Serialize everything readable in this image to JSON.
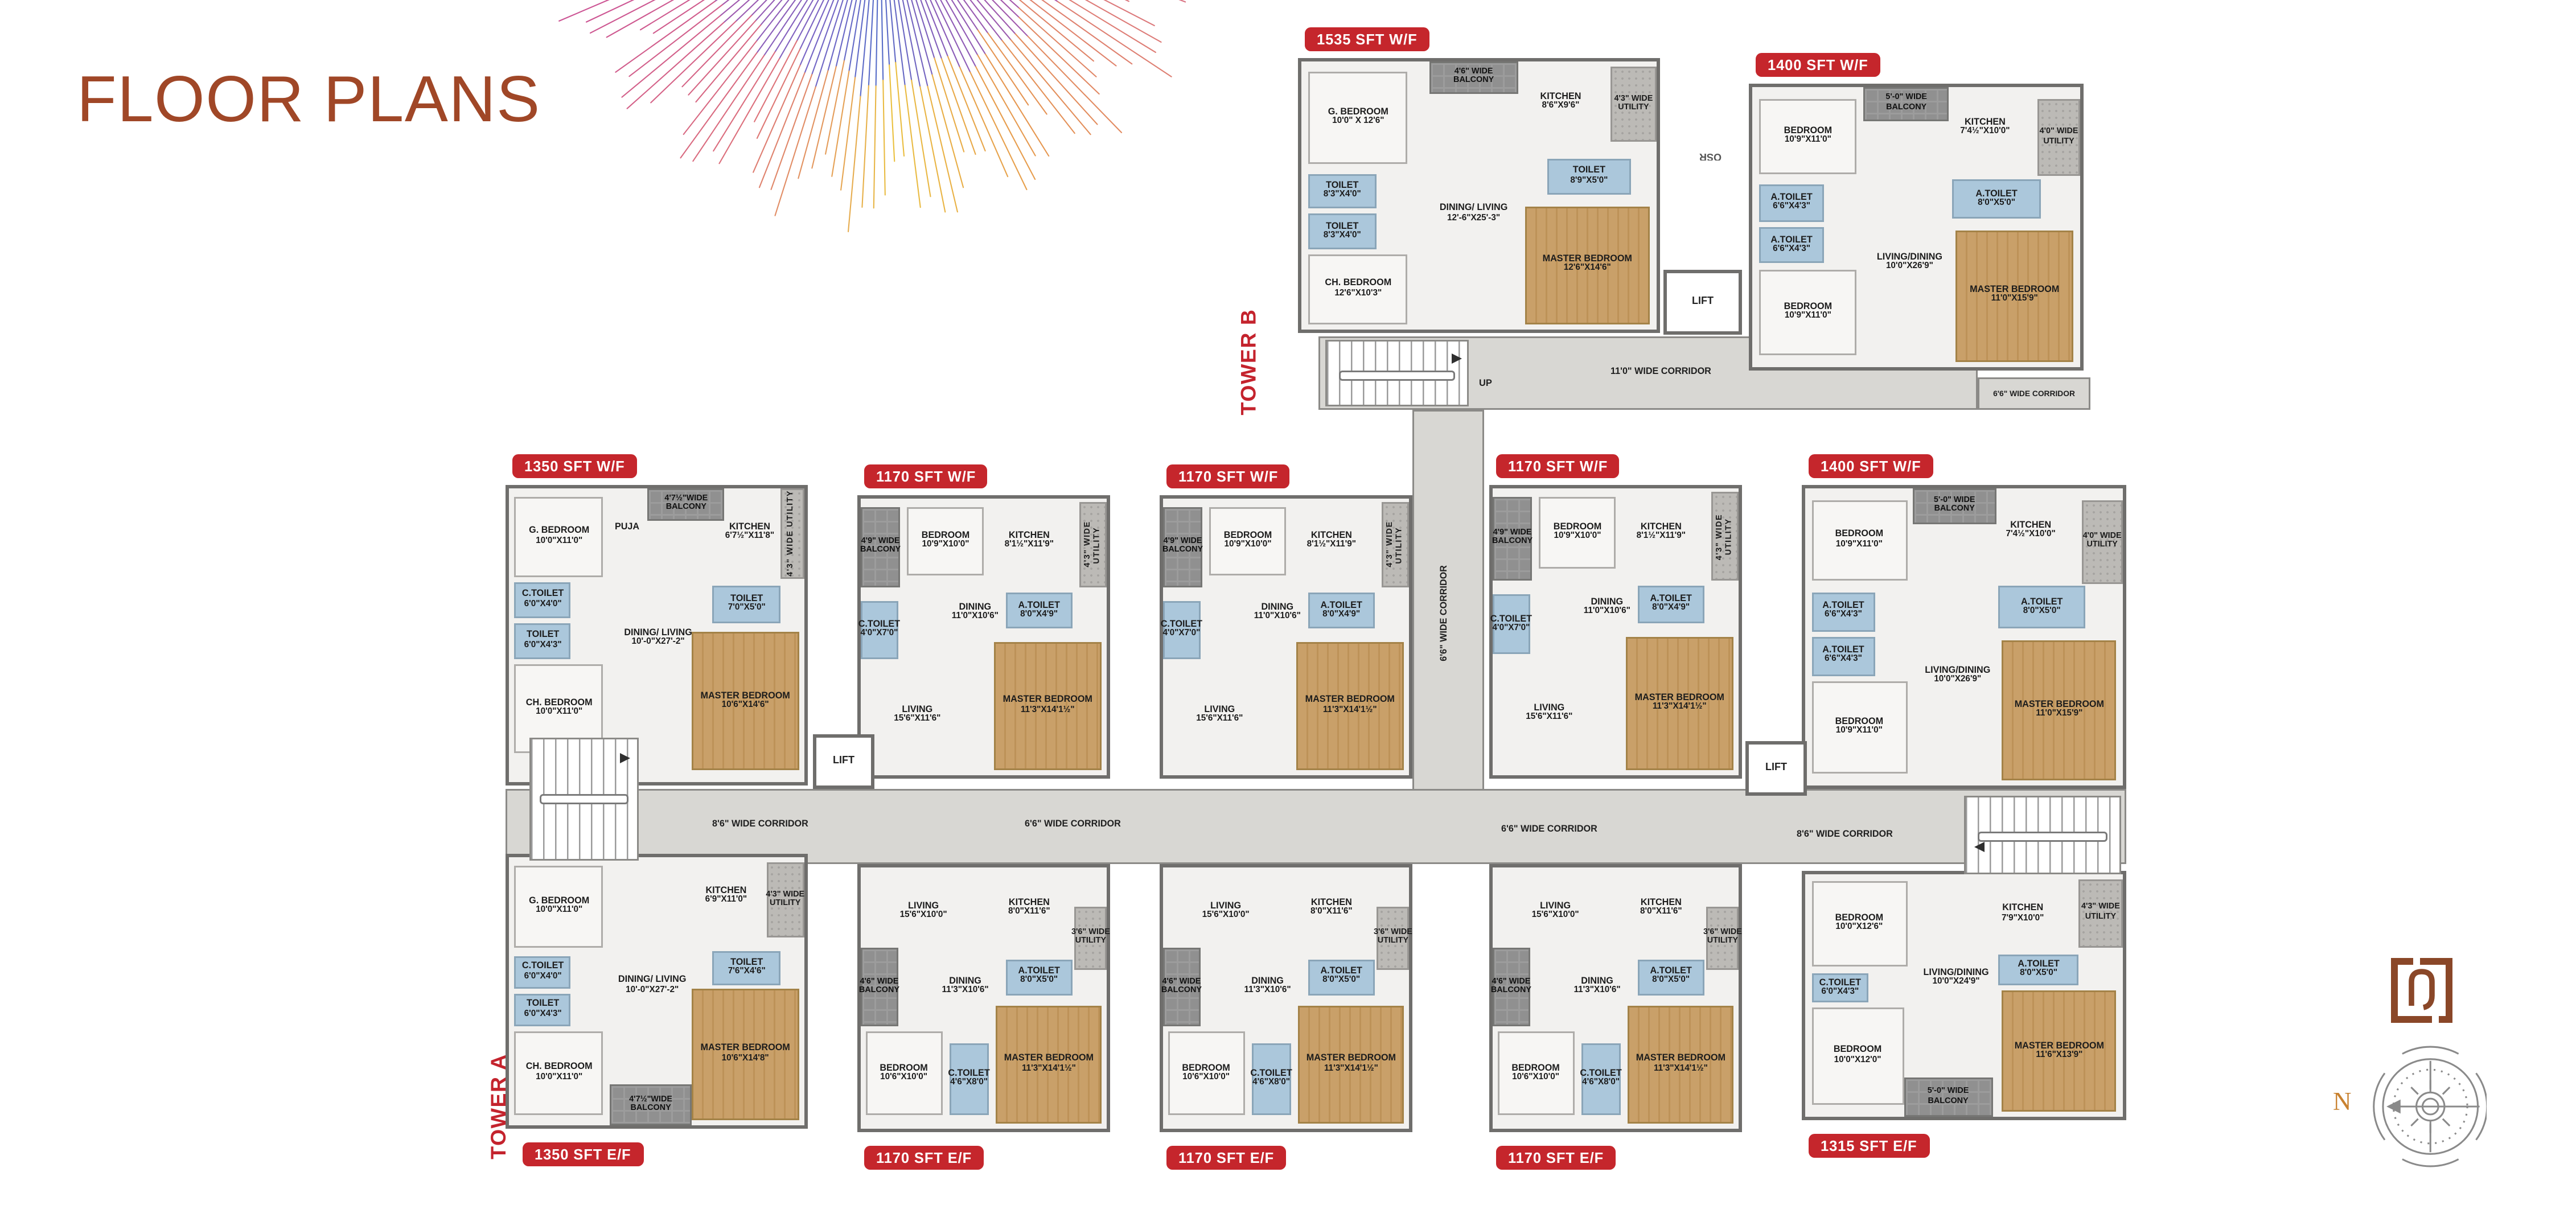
{
  "page": {
    "title": "FLOOR PLANS"
  },
  "colors": {
    "accent_brown": "#a04727",
    "badge_red": "#c5262c",
    "tower_red": "#c4232d",
    "toilet_blue": "#abc7db",
    "wood": "#c9a069",
    "corridor_gray": "#d8d7d3"
  },
  "towers": {
    "a": "TOWER A",
    "b": "TOWER B"
  },
  "corridors": {
    "b_main": "11'0\" WIDE CORRIDOR",
    "b_ext": "6'6\" WIDE CORRIDOR",
    "vertical": "6'6\" WIDE CORRIDOR",
    "a_labels": [
      "8'6\" WIDE CORRIDOR",
      "6'6\" WIDE CORRIDOR",
      "6'6\" WIDE CORRIDOR",
      "8'6\" WIDE CORRIDOR"
    ]
  },
  "misc": {
    "lift": "LIFT",
    "up": "UP",
    "osr": "OSR",
    "north": "N"
  },
  "unit_types": {
    "t1535": {
      "rooms": [
        {
          "n": "G. BEDROOM",
          "d": "10'0\" X 12'6\"",
          "k": "room",
          "x": 2,
          "y": 4,
          "w": 28,
          "h": 34
        },
        {
          "n": "4'6\" WIDE",
          "d": "BALCONY",
          "k": "balcony",
          "x": 36,
          "y": 0,
          "w": 25,
          "h": 12
        },
        {
          "n": "KITCHEN",
          "d": "8'6\"X9'6\"",
          "k": "open",
          "x": 61,
          "y": 5,
          "w": 24,
          "h": 20
        },
        {
          "n": "4'3\" WIDE",
          "d": "UTILITY",
          "k": "utility",
          "x": 87,
          "y": 2,
          "w": 13,
          "h": 28
        },
        {
          "n": "TOILET",
          "d": "8'3\"X4'0\"",
          "k": "toilet",
          "x": 2,
          "y": 42,
          "w": 19,
          "h": 13
        },
        {
          "n": "TOILET",
          "d": "8'3\"X4'0\"",
          "k": "toilet",
          "x": 2,
          "y": 57,
          "w": 19,
          "h": 13
        },
        {
          "n": "TOILET",
          "d": "8'9\"X5'0\"",
          "k": "toilet",
          "x": 69,
          "y": 36,
          "w": 24,
          "h": 14
        },
        {
          "n": "DINING/ LIVING",
          "d": "12'-6\"X25'-3\"",
          "k": "open",
          "x": 33,
          "y": 42,
          "w": 31,
          "h": 30
        },
        {
          "n": "CH. BEDROOM",
          "d": "12'6\"X10'3\"",
          "k": "room",
          "x": 2,
          "y": 72,
          "w": 28,
          "h": 26
        },
        {
          "n": "MASTER BEDROOM",
          "d": "12'6\"X14'6\"",
          "k": "wood",
          "x": 63,
          "y": 54,
          "w": 35,
          "h": 44
        }
      ]
    },
    "t1400": {
      "rooms": [
        {
          "n": "BEDROOM",
          "d": "10'9\"X11'0\"",
          "k": "room",
          "x": 2,
          "y": 4,
          "w": 30,
          "h": 27
        },
        {
          "n": "5'-0\" WIDE",
          "d": "BALCONY",
          "k": "balcony",
          "x": 34,
          "y": 0,
          "w": 26,
          "h": 12
        },
        {
          "n": "KITCHEN",
          "d": "7'4½\"X10'0\"",
          "k": "open",
          "x": 58,
          "y": 5,
          "w": 26,
          "h": 19
        },
        {
          "n": "4'0\" WIDE",
          "d": "UTILITY",
          "k": "utility",
          "x": 87,
          "y": 4,
          "w": 13,
          "h": 28
        },
        {
          "n": "A.TOILET",
          "d": "6'6\"X4'3\"",
          "k": "toilet",
          "x": 2,
          "y": 35,
          "w": 20,
          "h": 13
        },
        {
          "n": "A.TOILET",
          "d": "6'6\"X4'3\"",
          "k": "toilet",
          "x": 2,
          "y": 50,
          "w": 20,
          "h": 13
        },
        {
          "n": "A.TOILET",
          "d": "8'0\"X5'0\"",
          "k": "toilet",
          "x": 61,
          "y": 33,
          "w": 27,
          "h": 14
        },
        {
          "n": "BEDROOM",
          "d": "10'9\"X11'0\"",
          "k": "room",
          "x": 2,
          "y": 65,
          "w": 30,
          "h": 31
        },
        {
          "n": "LIVING/DINING",
          "d": "10'0\"X26'9\"",
          "k": "open",
          "x": 35,
          "y": 49,
          "w": 26,
          "h": 28
        },
        {
          "n": "MASTER BEDROOM",
          "d": "11'0\"X15'9\"",
          "k": "wood",
          "x": 62,
          "y": 51,
          "w": 36,
          "h": 47
        }
      ]
    },
    "t1350wf": {
      "rooms": [
        {
          "n": "G. BEDROOM",
          "d": "10'0\"X11'0\"",
          "k": "room",
          "x": 2,
          "y": 3,
          "w": 30,
          "h": 27
        },
        {
          "n": "PUJA",
          "d": "",
          "k": "open",
          "x": 34,
          "y": 9,
          "w": 12,
          "h": 9
        },
        {
          "n": "4'7½\"WIDE",
          "d": "BALCONY",
          "k": "balcony",
          "x": 47,
          "y": 0,
          "w": 26,
          "h": 11
        },
        {
          "n": "KITCHEN",
          "d": "6'7½\"X11'8\"",
          "k": "open",
          "x": 71,
          "y": 4,
          "w": 21,
          "h": 22
        },
        {
          "n": "4'3\" WIDE UTILITY",
          "d": "",
          "k": "utility",
          "x": 92,
          "y": 0,
          "w": 8,
          "h": 31,
          "vert": true
        },
        {
          "n": "C.TOILET",
          "d": "6'0\"X4'0\"",
          "k": "toilet",
          "x": 2,
          "y": 32,
          "w": 19,
          "h": 12
        },
        {
          "n": "TOILET",
          "d": "6'0\"X4'3\"",
          "k": "toilet",
          "x": 2,
          "y": 46,
          "w": 19,
          "h": 12
        },
        {
          "n": "TOILET",
          "d": "7'0\"X5'0\"",
          "k": "toilet",
          "x": 69,
          "y": 33,
          "w": 23,
          "h": 13
        },
        {
          "n": "DINING/ LIVING",
          "d": "10'-0\"X27'-2\"",
          "k": "open",
          "x": 35,
          "y": 38,
          "w": 31,
          "h": 26
        },
        {
          "n": "CH. BEDROOM",
          "d": "10'0\"X11'0\"",
          "k": "room",
          "x": 2,
          "y": 60,
          "w": 30,
          "h": 30
        },
        {
          "n": "MASTER BEDROOM",
          "d": "10'6\"X14'6\"",
          "k": "wood",
          "x": 62,
          "y": 49,
          "w": 36,
          "h": 47
        }
      ]
    },
    "t1170wf": {
      "rooms": [
        {
          "n": "4'9\" WIDE",
          "d": "BALCONY",
          "k": "balcony",
          "x": 0,
          "y": 3,
          "w": 16,
          "h": 29
        },
        {
          "n": "BEDROOM",
          "d": "10'9\"X10'0\"",
          "k": "room",
          "x": 19,
          "y": 3,
          "w": 31,
          "h": 25
        },
        {
          "n": "KITCHEN",
          "d": "8'1½\"X11'9\"",
          "k": "open",
          "x": 54,
          "y": 4,
          "w": 29,
          "h": 23
        },
        {
          "n": "4'3\" WIDE UTILITY",
          "d": "",
          "k": "utility",
          "x": 89,
          "y": 1,
          "w": 11,
          "h": 31,
          "vert": true
        },
        {
          "n": "C.TOILET",
          "d": "4'0\"X7'0\"",
          "k": "toilet",
          "x": 0,
          "y": 37,
          "w": 15,
          "h": 21
        },
        {
          "n": "DINING",
          "d": "11'0\"X10'6\"",
          "k": "open",
          "x": 31,
          "y": 31,
          "w": 31,
          "h": 21
        },
        {
          "n": "A.TOILET",
          "d": "8'0\"X4'9\"",
          "k": "toilet",
          "x": 59,
          "y": 34,
          "w": 27,
          "h": 13
        },
        {
          "n": "LIVING",
          "d": "15'6\"X11'6\"",
          "k": "open",
          "x": 5,
          "y": 63,
          "w": 36,
          "h": 31
        },
        {
          "n": "MASTER BEDROOM",
          "d": "11'3\"X14'1½\"",
          "k": "wood",
          "x": 54,
          "y": 52,
          "w": 44,
          "h": 46
        }
      ]
    },
    "t1350ef": {
      "rooms": [
        {
          "n": "G. BEDROOM",
          "d": "10'0\"X11'0\"",
          "k": "room",
          "x": 2,
          "y": 3,
          "w": 30,
          "h": 31
        },
        {
          "n": "KITCHEN",
          "d": "6'9\"X11'0\"",
          "k": "open",
          "x": 61,
          "y": 4,
          "w": 25,
          "h": 21
        },
        {
          "n": "4'3\" WIDE",
          "d": "UTILITY",
          "k": "utility",
          "x": 87,
          "y": 2,
          "w": 13,
          "h": 28
        },
        {
          "n": "C.TOILET",
          "d": "6'0\"X4'0\"",
          "k": "toilet",
          "x": 2,
          "y": 37,
          "w": 19,
          "h": 12
        },
        {
          "n": "TOILET",
          "d": "6'0\"X4'3\"",
          "k": "toilet",
          "x": 2,
          "y": 51,
          "w": 19,
          "h": 12
        },
        {
          "n": "DINING/ LIVING",
          "d": "10'-0\"X27'-2\"",
          "k": "open",
          "x": 33,
          "y": 35,
          "w": 31,
          "h": 26
        },
        {
          "n": "TOILET",
          "d": "7'6\"X4'6\"",
          "k": "toilet",
          "x": 69,
          "y": 35,
          "w": 23,
          "h": 13
        },
        {
          "n": "CH. BEDROOM",
          "d": "10'0\"X11'0\"",
          "k": "room",
          "x": 2,
          "y": 65,
          "w": 30,
          "h": 31
        },
        {
          "n": "4'7½\"WIDE",
          "d": "BALCONY",
          "k": "balcony",
          "x": 34,
          "y": 85,
          "w": 28,
          "h": 15
        },
        {
          "n": "MASTER BEDROOM",
          "d": "10'6\"X14'8\"",
          "k": "wood",
          "x": 62,
          "y": 49,
          "w": 36,
          "h": 49
        }
      ]
    },
    "t1170ef": {
      "rooms": [
        {
          "n": "LIVING",
          "d": "15'6\"X10'0\"",
          "k": "open",
          "x": 5,
          "y": 3,
          "w": 41,
          "h": 28
        },
        {
          "n": "KITCHEN",
          "d": "8'0\"X11'6\"",
          "k": "open",
          "x": 54,
          "y": 3,
          "w": 29,
          "h": 25
        },
        {
          "n": "3'6\" WIDE",
          "d": "UTILITY",
          "k": "utility",
          "x": 87,
          "y": 15,
          "w": 13,
          "h": 24
        },
        {
          "n": "4'6\" WIDE",
          "d": "BALCONY",
          "k": "balcony",
          "x": 0,
          "y": 31,
          "w": 15,
          "h": 30
        },
        {
          "n": "DINING",
          "d": "11'3\"X10'6\"",
          "k": "open",
          "x": 27,
          "y": 35,
          "w": 31,
          "h": 21
        },
        {
          "n": "A.TOILET",
          "d": "8'0\"X5'0\"",
          "k": "toilet",
          "x": 59,
          "y": 35,
          "w": 27,
          "h": 14
        },
        {
          "n": "BEDROOM",
          "d": "10'6\"X10'0\"",
          "k": "room",
          "x": 2,
          "y": 63,
          "w": 31,
          "h": 32
        },
        {
          "n": "C.TOILET",
          "d": "4'6\"X8'0\"",
          "k": "toilet",
          "x": 36,
          "y": 67,
          "w": 16,
          "h": 28
        },
        {
          "n": "MASTER BEDROOM",
          "d": "11'3\"X14'1½\"",
          "k": "wood",
          "x": 55,
          "y": 53,
          "w": 43,
          "h": 45
        }
      ]
    },
    "t1315ef": {
      "rooms": [
        {
          "n": "BEDROOM",
          "d": "10'0\"X12'6\"",
          "k": "room",
          "x": 2,
          "y": 3,
          "w": 30,
          "h": 35
        },
        {
          "n": "KITCHEN",
          "d": "7'9\"X10'0\"",
          "k": "open",
          "x": 55,
          "y": 6,
          "w": 27,
          "h": 21
        },
        {
          "n": "4'3\" WIDE",
          "d": "UTILITY",
          "k": "utility",
          "x": 86,
          "y": 2,
          "w": 14,
          "h": 28
        },
        {
          "n": "C.TOILET",
          "d": "6'0\"X4'3\"",
          "k": "toilet",
          "x": 2,
          "y": 41,
          "w": 18,
          "h": 12
        },
        {
          "n": "LIVING/DINING",
          "d": "10'0\"X24'9\"",
          "k": "open",
          "x": 33,
          "y": 29,
          "w": 29,
          "h": 28
        },
        {
          "n": "A.TOILET",
          "d": "8'0\"X5'0\"",
          "k": "toilet",
          "x": 61,
          "y": 33,
          "w": 25,
          "h": 13
        },
        {
          "n": "BEDROOM",
          "d": "10'0\"X12'0\"",
          "k": "room",
          "x": 2,
          "y": 55,
          "w": 29,
          "h": 40
        },
        {
          "n": "5'-0\" WIDE",
          "d": "BALCONY",
          "k": "balcony",
          "x": 31,
          "y": 84,
          "w": 28,
          "h": 16
        },
        {
          "n": "MASTER BEDROOM",
          "d": "11'6\"X13'9\"",
          "k": "wood",
          "x": 62,
          "y": 48,
          "w": 36,
          "h": 50
        }
      ]
    }
  },
  "units": [
    {
      "id": "b1",
      "label": "1535 SFT W/F",
      "type": "t1535",
      "tower": "B"
    },
    {
      "id": "b2",
      "label": "1400 SFT W/F",
      "type": "t1400",
      "tower": "B"
    },
    {
      "id": "a1",
      "label": "1350 SFT W/F",
      "type": "t1350wf",
      "tower": "A"
    },
    {
      "id": "a2",
      "label": "1170 SFT W/F",
      "type": "t1170wf",
      "tower": "A"
    },
    {
      "id": "a3",
      "label": "1170 SFT W/F",
      "type": "t1170wf",
      "tower": "A"
    },
    {
      "id": "a4",
      "label": "1170 SFT W/F",
      "type": "t1170wf",
      "tower": "A"
    },
    {
      "id": "a5",
      "label": "1400 SFT W/F",
      "type": "t1400",
      "tower": "A"
    },
    {
      "id": "a6",
      "label": "1350 SFT E/F",
      "type": "t1350ef",
      "tower": "A"
    },
    {
      "id": "a7",
      "label": "1170 SFT E/F",
      "type": "t1170ef",
      "tower": "A"
    },
    {
      "id": "a8",
      "label": "1170 SFT E/F",
      "type": "t1170ef",
      "tower": "A"
    },
    {
      "id": "a9",
      "label": "1170 SFT E/F",
      "type": "t1170ef",
      "tower": "A"
    },
    {
      "id": "a10",
      "label": "1315 SFT E/F",
      "type": "t1315ef",
      "tower": "A"
    }
  ]
}
